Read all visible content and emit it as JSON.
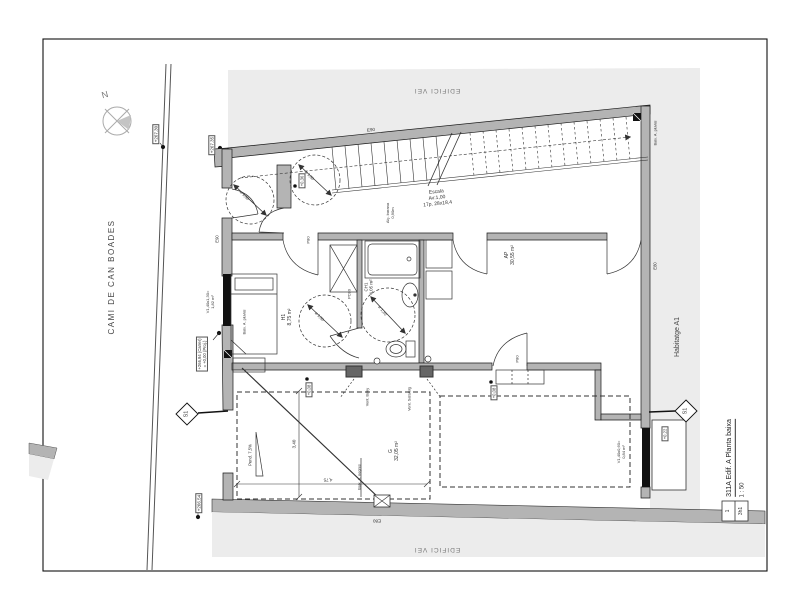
{
  "drawing_labels": {
    "street_name": "CAMI DE CAN BOADES",
    "north": "N",
    "neighbor_top": "EDIFICI VEI",
    "neighbor_bottom": "EDIFICI VEI",
    "unit": "Habitatge A1"
  },
  "elevation_markers": {
    "road_upper": "+267.30",
    "road_lower": "+267.35",
    "entry": "+266,94 (Carrer)\n= +0,00 (Proj.)",
    "driveway": "+266.54"
  },
  "level_markers": {
    "stair_landing": "+0,36",
    "garage_left": "+0,08",
    "garage_right": "+0,08",
    "rear_porch": "+0,22"
  },
  "walls": {
    "top": "E90",
    "left": "E90",
    "right": "E80",
    "bottom": "E80"
  },
  "stairs": {
    "label": "Escala\nAv:1,00\n17p. 28x18,4",
    "railing": "Alç. barana\n0,90m"
  },
  "rooms": {
    "bedroom": "H1\n8,75 m²",
    "bathroom": "CH1\n4,05 m²",
    "living": "AP\n30,55 m²",
    "garage": "G\n32,05 m²"
  },
  "doors": {
    "bedroom": "P80",
    "bathroom_sliding": "PC80",
    "garage": "P80"
  },
  "windows": {
    "street": "V1,40x1,30=\n1,82 m²",
    "rear": "V1,40x0,60=\n0,84 m²"
  },
  "turning_circles": {
    "entry": "ø 1,50",
    "landing": "ø 1,50",
    "bedroom": "ø 1,50",
    "bathroom": "ø 1,20"
  },
  "plumbing": {
    "pluvial_street": "Baix. A. pluvial",
    "pluvial_rear": "Baix. A. pluvial",
    "sewage": "Baix. A. negres"
  },
  "vents": {
    "bathroom": "Vent. Bany",
    "laundry": "Vent. Safareig"
  },
  "ramp_slope": "Pend. 7,5%",
  "dimensions": {
    "garage_depth": "3,40",
    "garage_width": "4,75"
  },
  "section_markers": {
    "left": "S1",
    "right": "S1"
  },
  "title_block": {
    "title": "311A Edif. A Planta baixa",
    "scale": "1 : 50",
    "sheet": "1",
    "ref": "3h1"
  }
}
